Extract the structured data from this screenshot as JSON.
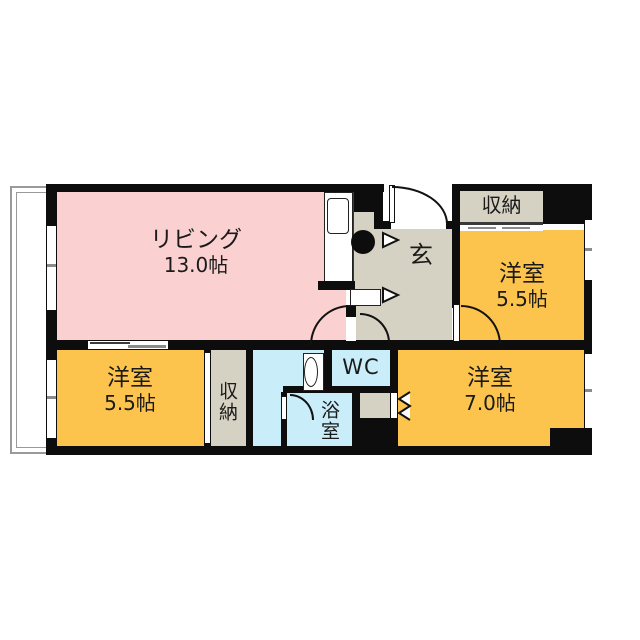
{
  "floorplan": {
    "rooms": {
      "living": {
        "name": "リビング",
        "area": "13.0帖"
      },
      "bedroom_tr": {
        "name": "洋室",
        "area": "5.5帖"
      },
      "bedroom_bl": {
        "name": "洋室",
        "area": "5.5帖"
      },
      "bedroom_br": {
        "name": "洋室",
        "area": "7.0帖"
      },
      "closet_tr": {
        "name": "収納"
      },
      "closet_bl": {
        "name": "収納"
      },
      "wc": {
        "name": "WC"
      },
      "bath": {
        "name": "浴室"
      },
      "entrance": {
        "name": "玄"
      }
    },
    "colors": {
      "living": "#fbd0d0",
      "bedroom": "#fcc44d",
      "hall": "#d6d2c3",
      "wet": "#c9edf9",
      "wall": "#0d0d0d",
      "balcony": "#9a9a9a"
    }
  }
}
